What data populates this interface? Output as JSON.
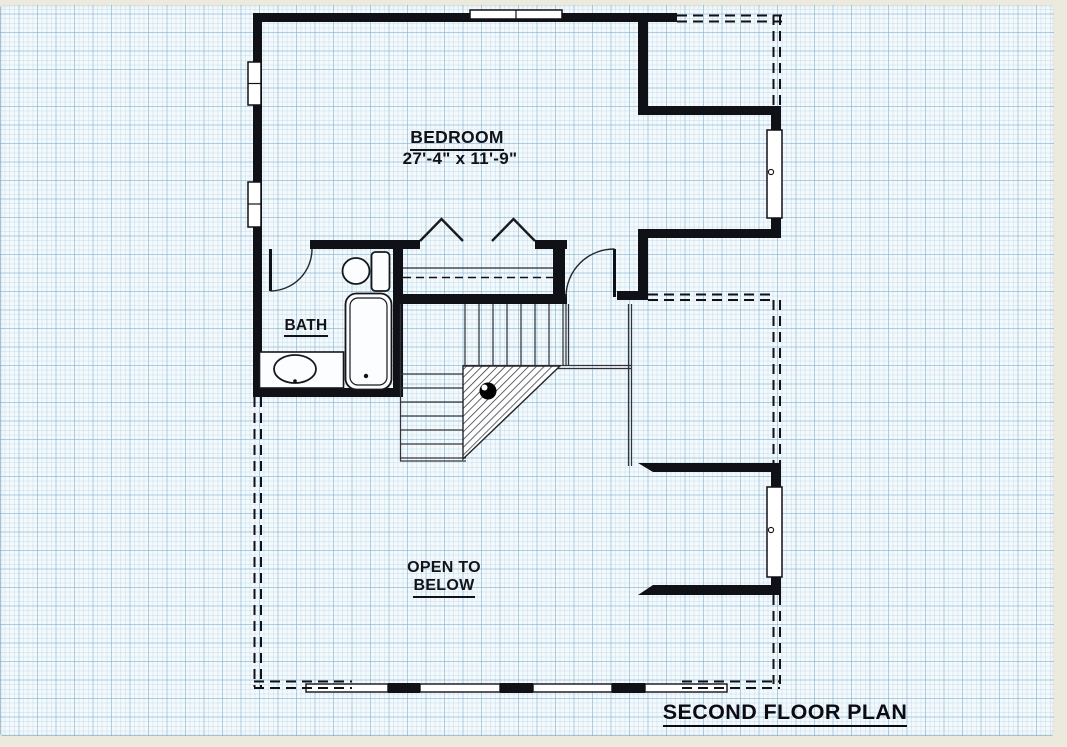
{
  "plan": {
    "title": "SECOND FLOOR PLAN",
    "bedroom_label": "BEDROOM",
    "bedroom_dimensions": "27'-4\" x 11'-9\"",
    "bath_label": "BATH",
    "open_to_below_line1": "OPEN TO",
    "open_to_below_line2": "BELOW"
  },
  "colors": {
    "paper_margin": "#ece9dd",
    "grid_background": "#f4f9fc",
    "grid_line": "#7daecd",
    "wall": "#101017",
    "label_text": "#121219"
  }
}
